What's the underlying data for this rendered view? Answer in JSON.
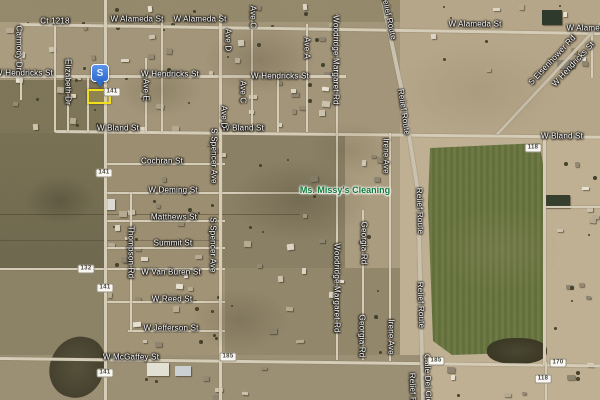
{
  "colors": {
    "label-text": "#ffffff",
    "business-text": "#0f7a39",
    "marker-blue": "#3f7de0",
    "highlight-yellow": "#f2de1c",
    "shield-bg": "#f8f7f3",
    "shield-border": "#98927f",
    "shield-text": "#46423a",
    "field-green": "#68743f",
    "road": "#d7ceb9"
  },
  "marker": {
    "glyph": "S",
    "x": 100,
    "y": 87,
    "highlight": {
      "x": 87,
      "y": 89,
      "w": 20,
      "h": 11
    }
  },
  "labels": {
    "business": {
      "text": "Ms. Missy's Cleaning",
      "x": 345,
      "y": 190
    },
    "streets": [
      {
        "text": "Ct 1218",
        "x": 55,
        "y": 21,
        "rot": 0
      },
      {
        "text": "W Alameda St",
        "x": 137,
        "y": 19,
        "rot": 0
      },
      {
        "text": "W Alameda St",
        "x": 200,
        "y": 19,
        "rot": 0
      },
      {
        "text": "W Alameda St",
        "x": 475,
        "y": 24,
        "rot": 0
      },
      {
        "text": "W Alameda St",
        "x": 593,
        "y": 28,
        "rot": 0
      },
      {
        "text": "W Hendricks St",
        "x": 24,
        "y": 73,
        "rot": 0
      },
      {
        "text": "W Hendricks St",
        "x": 170,
        "y": 74,
        "rot": 0
      },
      {
        "text": "W Hendricks St",
        "x": 280,
        "y": 76,
        "rot": 0
      },
      {
        "text": "W Bland St",
        "x": 118,
        "y": 128,
        "rot": 0
      },
      {
        "text": "W Bland St",
        "x": 243,
        "y": 128,
        "rot": 0
      },
      {
        "text": "W Bland St",
        "x": 562,
        "y": 136,
        "rot": 0
      },
      {
        "text": "Cochran St",
        "x": 162,
        "y": 161,
        "rot": 0
      },
      {
        "text": "W Deming St",
        "x": 173,
        "y": 190,
        "rot": 0
      },
      {
        "text": "Matthews St",
        "x": 174,
        "y": 217,
        "rot": 0
      },
      {
        "text": "Summit St",
        "x": 173,
        "y": 243,
        "rot": 0
      },
      {
        "text": "W Van Buren St",
        "x": 171,
        "y": 272,
        "rot": 0
      },
      {
        "text": "W Reed St",
        "x": 172,
        "y": 299,
        "rot": 0
      },
      {
        "text": "W Jefferson St",
        "x": 171,
        "y": 328,
        "rot": 0
      },
      {
        "text": "W McGaffey St",
        "x": 131,
        "y": 357,
        "rot": 0
      },
      {
        "text": "Carmody Dr",
        "x": 19,
        "y": 48,
        "rot": 90
      },
      {
        "text": "Elizabeth Dr",
        "x": 68,
        "y": 82,
        "rot": 90
      },
      {
        "text": "Ave E",
        "x": 146,
        "y": 90,
        "rot": 90
      },
      {
        "text": "Ave C",
        "x": 253,
        "y": 17,
        "rot": 90
      },
      {
        "text": "Ave D",
        "x": 228,
        "y": 40,
        "rot": 90
      },
      {
        "text": "Ave A",
        "x": 307,
        "y": 48,
        "rot": 90
      },
      {
        "text": "Ave C",
        "x": 243,
        "y": 92,
        "rot": 90
      },
      {
        "text": "Ave D",
        "x": 224,
        "y": 117,
        "rot": 90
      },
      {
        "text": "Woodridge Margaret Rd",
        "x": 336,
        "y": 60,
        "rot": 90
      },
      {
        "text": "Woodridge Margaret Rd",
        "x": 337,
        "y": 288,
        "rot": 90
      },
      {
        "text": "S Spencer Ave",
        "x": 214,
        "y": 156,
        "rot": 90
      },
      {
        "text": "S Spencer Ave",
        "x": 213,
        "y": 245,
        "rot": 90
      },
      {
        "text": "Thompson Rd",
        "x": 131,
        "y": 252,
        "rot": 90
      },
      {
        "text": "Georgia Rd",
        "x": 364,
        "y": 243,
        "rot": 90
      },
      {
        "text": "Georgia Rd",
        "x": 362,
        "y": 336,
        "rot": 90
      },
      {
        "text": "Irene Ave",
        "x": 386,
        "y": 156,
        "rot": 90
      },
      {
        "text": "Irene Ave",
        "x": 391,
        "y": 337,
        "rot": 90
      },
      {
        "text": "Relief Route",
        "x": 389,
        "y": 17,
        "rot": 78
      },
      {
        "text": "Relief Route",
        "x": 404,
        "y": 112,
        "rot": 82
      },
      {
        "text": "Relief Route",
        "x": 420,
        "y": 211,
        "rot": 88
      },
      {
        "text": "Relief Route",
        "x": 421,
        "y": 305,
        "rot": 88
      },
      {
        "text": "Relief Route",
        "x": 413,
        "y": 396,
        "rot": 88
      },
      {
        "text": "Calle Del Cielo",
        "x": 428,
        "y": 382,
        "rot": 88
      },
      {
        "text": "S Eisenhower Rd",
        "x": 552,
        "y": 60,
        "rot": -47
      },
      {
        "text": "W Hendricks St",
        "x": 573,
        "y": 64,
        "rot": -47
      }
    ]
  },
  "route_shields": [
    {
      "number": "141",
      "x": 112,
      "y": 92
    },
    {
      "number": "141",
      "x": 104,
      "y": 173
    },
    {
      "number": "132",
      "x": 86,
      "y": 269
    },
    {
      "number": "141",
      "x": 105,
      "y": 288
    },
    {
      "number": "141",
      "x": 105,
      "y": 373
    },
    {
      "number": "118",
      "x": 533,
      "y": 148
    },
    {
      "number": "185",
      "x": 228,
      "y": 357
    },
    {
      "number": "185",
      "x": 436,
      "y": 361
    },
    {
      "number": "170",
      "x": 558,
      "y": 363
    },
    {
      "number": "118",
      "x": 543,
      "y": 379
    }
  ]
}
